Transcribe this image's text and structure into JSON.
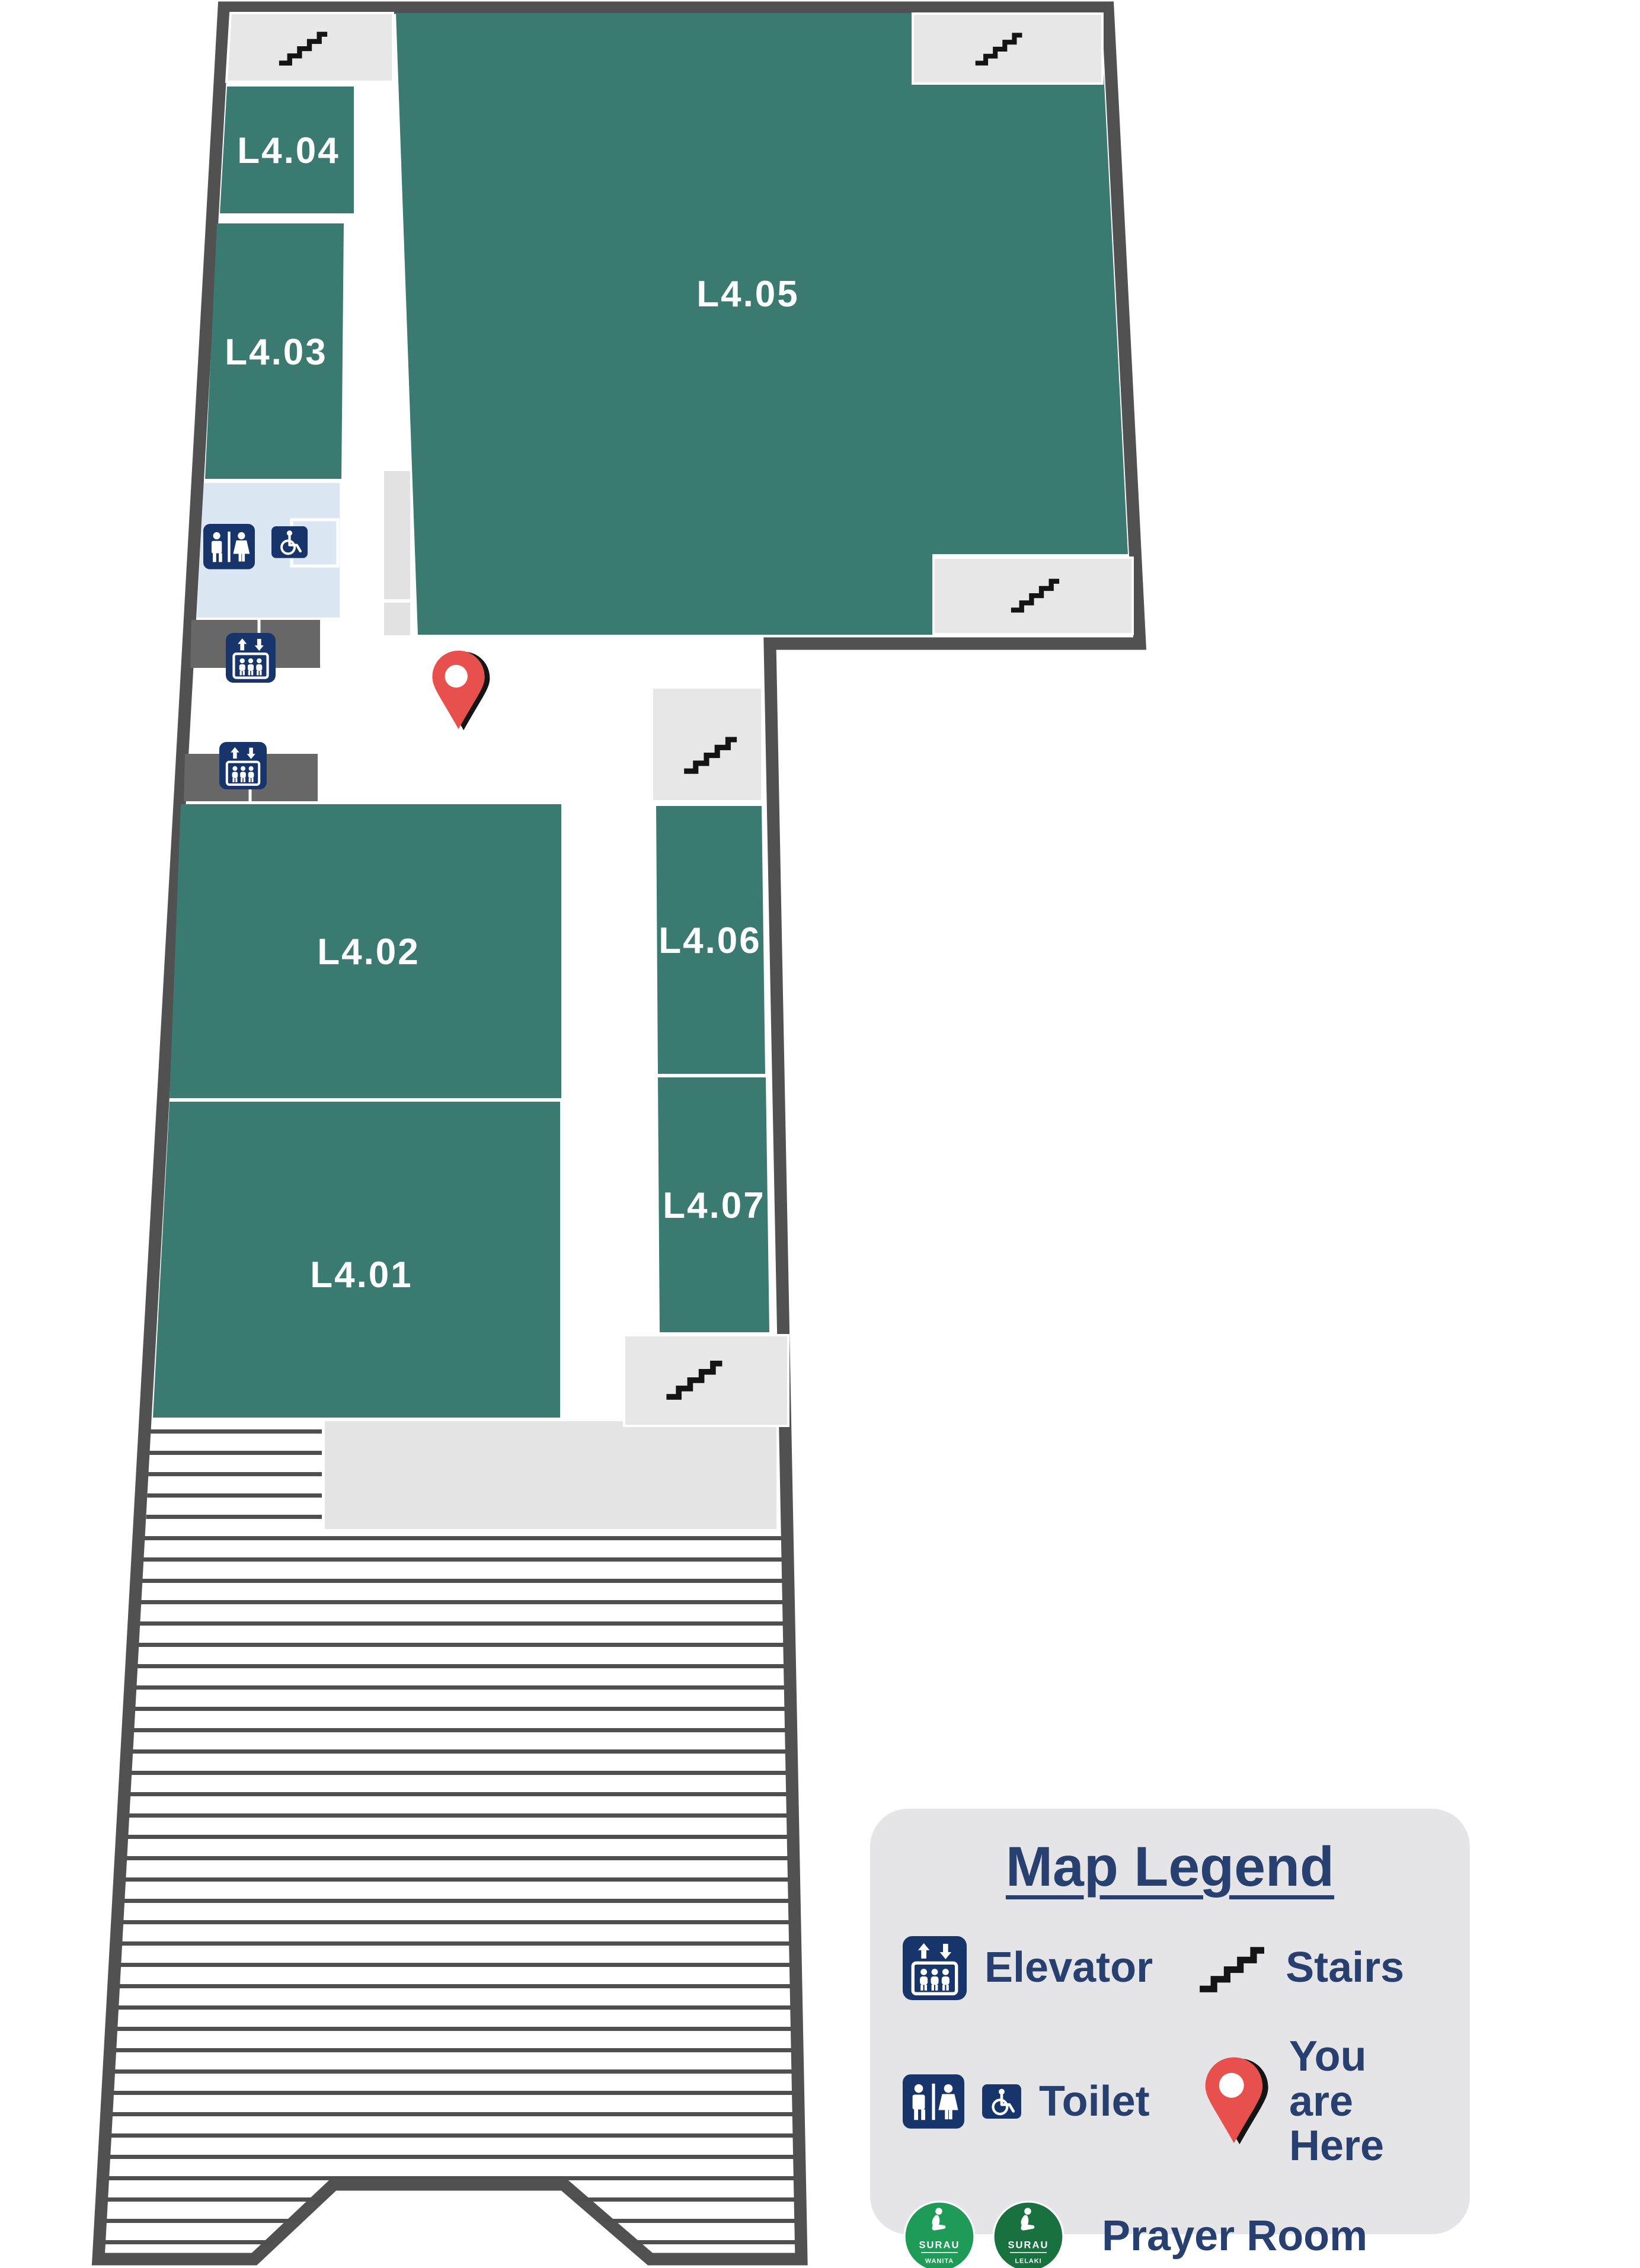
{
  "map": {
    "rooms": {
      "l401": "L4.01",
      "l402": "L4.02",
      "l403": "L4.03",
      "l404": "L4.04",
      "l405": "L4.05",
      "l406": "L4.06",
      "l407": "L4.07"
    }
  },
  "legend": {
    "title": "Map Legend",
    "elevator_label": "Elevator",
    "stairs_label": "Stairs",
    "toilet_label": "Toilet",
    "you_are_here_label": "You are Here",
    "prayer_room_label": "Prayer Room",
    "surau_wanita_title": "SURAU",
    "surau_wanita_subtitle": "WANITA",
    "surau_lelaki_title": "SURAU",
    "surau_lelaki_subtitle": "LELAKI"
  },
  "colors": {
    "room_green": "#3a7a71",
    "wall_gray": "#515151",
    "stairs_room_gray": "#e7e7e7",
    "elevator_lobby_gray": "#676767",
    "toilet_room_blue": "#dce7f4",
    "corridor_strip_gray": "#e2e2e2",
    "legend_panel_gray": "#e5e4e7",
    "icon_navy": "#17356b",
    "text_navy": "#27406f",
    "pin_red": "#e8504d",
    "surau_green_wanita": "#1d9b57",
    "surau_green_lelaki": "#19713f"
  }
}
